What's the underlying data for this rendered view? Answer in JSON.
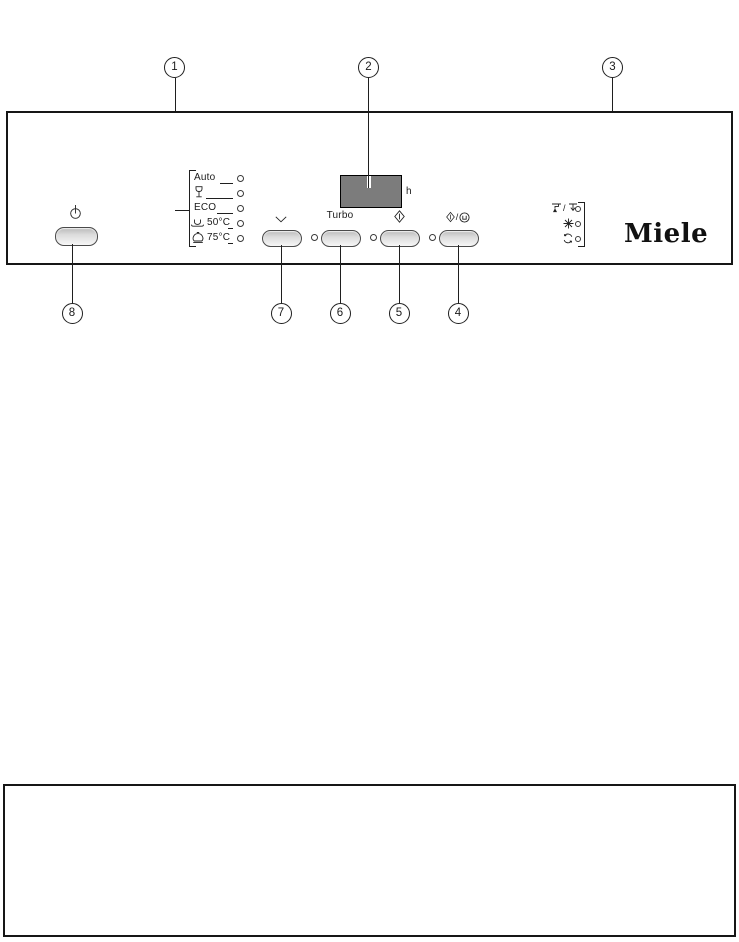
{
  "callouts": {
    "n1": "1",
    "n2": "2",
    "n3": "3",
    "n4": "4",
    "n5": "5",
    "n6": "6",
    "n7": "7",
    "n8": "8"
  },
  "programs": {
    "auto_label": "Auto",
    "eco_label": "ECO",
    "temp50_label": "50°C",
    "temp75_label": "75°C",
    "icons": [
      "wine-glass-icon",
      "cup-saucer-icon",
      "pot-icon"
    ]
  },
  "display": {
    "unit_label": "h"
  },
  "controls": {
    "turbo_label": "Turbo",
    "start_drain_separator": "/",
    "icons": [
      "power-icon",
      "chevron-down-icon",
      "start-icon",
      "start-drain-icon"
    ]
  },
  "indicators": {
    "separator": "/",
    "icons": [
      "water-inlet-icon",
      "water-drain-icon",
      "rinse-aid-icon",
      "salt-icon"
    ]
  },
  "brand": {
    "logo_text": "Miele"
  },
  "colors": {
    "line": "#1f1f1f",
    "display_fill": "#7c7c7c",
    "button_fill": "#dcdcdc",
    "background": "#ffffff"
  }
}
